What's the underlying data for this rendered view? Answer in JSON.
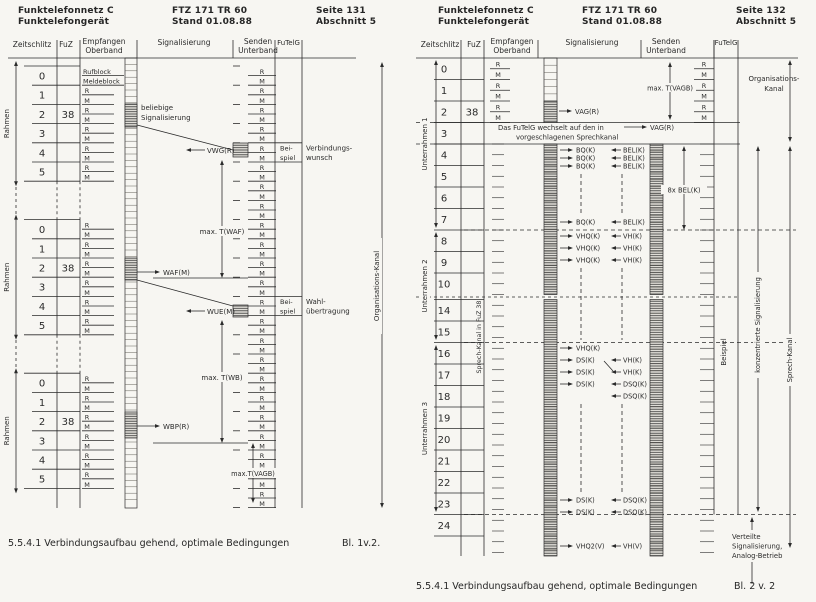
{
  "ink": "#2b2b2b",
  "paper": "#f7f6f2",
  "pages": [
    {
      "name": "seite-131",
      "header_left": [
        "Funktelefonnetz C",
        "Funktelefongerät"
      ],
      "header_center": [
        "FTZ 171 TR 60",
        "Stand 01.08.88"
      ],
      "header_right": [
        "Seite 131",
        "Abschnitt 5"
      ],
      "columns": {
        "zeitschlitz": "Zeitschlitz",
        "fuz": "FuZ",
        "empfangen": [
          "Empfangen",
          "Oberband"
        ],
        "signalisierung": "Signalisierung",
        "senden": [
          "Senden",
          "Unterband"
        ],
        "futelg": "FuTelG"
      },
      "rm": [
        "R",
        "M"
      ],
      "slot0_rx": [
        "Rufblock",
        "Meldeblock"
      ],
      "frame_label": "Rahmen",
      "fuz_value": "38",
      "slots": [
        "0",
        "1",
        "2",
        "3",
        "4",
        "5"
      ],
      "signals": {
        "beliebige": [
          "beliebige",
          "Signalisierung"
        ],
        "vwg": "VWG(R)",
        "max_waf": "max. T(WAF)",
        "waf": "WAF(M)",
        "wue": "WUE(M)",
        "max_wb": "max. T(WB)",
        "wbp": "WBP(R)",
        "max_vagb": "max.T(VAGB)"
      },
      "beispiel": [
        "Bei-",
        "spiel"
      ],
      "notes": {
        "verbindungswunsch": [
          "Verbindungs-",
          "wunsch"
        ],
        "wahluebertragung": [
          "Wahl-",
          "übertragung"
        ]
      },
      "channel_label": "Organisations-Kanal",
      "caption": "5.5.4.1 Verbindungsaufbau gehend, optimale Bedingungen",
      "sheet": "Bl. 1v.2."
    },
    {
      "name": "seite-132",
      "header_left": [
        "Funktelefonnetz C",
        "Funktelefongerät"
      ],
      "header_center": [
        "FTZ 171 TR 60",
        "Stand 01.08.88"
      ],
      "header_right": [
        "Seite 132",
        "Abschnitt 5"
      ],
      "columns": {
        "zeitschlitz": "Zeitschlitz",
        "fuz": "FuZ",
        "empfangen": [
          "Empfangen",
          "Oberband"
        ],
        "signalisierung": "Signalisierung",
        "senden": [
          "Senden",
          "Unterband"
        ],
        "futelg": "FuTelG"
      },
      "rm": [
        "R",
        "M"
      ],
      "fuz_value": "38",
      "rows": [
        "0",
        "1",
        "2",
        "3",
        "4",
        "5",
        "6",
        "7",
        "8",
        "9",
        "10",
        "14",
        "15",
        "16",
        "17",
        "18",
        "19",
        "20",
        "21",
        "22",
        "23",
        "24"
      ],
      "subframes": [
        "Unterrahmen 1",
        "Unterrahmen 2",
        "Unterrahmen 3"
      ],
      "sprech_fuz_label": "Sprech-Kanal in FuZ 38",
      "row3_text": [
        "Das FuTelG wechselt auf den in",
        "vorgeschlagenen Sprechkanal"
      ],
      "vag": "VAG(R)",
      "max_vagb": "max. T(VAGB)",
      "org_label": [
        "Organisations-",
        "Kanal"
      ],
      "events": [
        {
          "y": 150,
          "right": "BQ(K)",
          "left": "BEL(K)"
        },
        {
          "y": 158,
          "right": "BQ(K)",
          "left": "BEL(K)"
        },
        {
          "y": 166,
          "right": "BQ(K)",
          "left": "BEL(K)"
        },
        {
          "dash": [
            174,
            216
          ]
        },
        {
          "y": 222,
          "right": "BQ(K)",
          "left": "BEL(K)"
        },
        {
          "y": 236,
          "right": "VHQ(K)",
          "left": "VH(K)"
        },
        {
          "y": 248,
          "right": "VHQ(K)",
          "left": "VH(K)"
        },
        {
          "y": 260,
          "right": "VHQ(K)",
          "left": "VH(K)"
        },
        {
          "dash": [
            268,
            340
          ]
        },
        {
          "y": 348,
          "right": "VHQ(K)"
        },
        {
          "y": 360,
          "right": "DS(K)",
          "left": "VH(K)"
        },
        {
          "y": 372,
          "right": "DS(K)",
          "left": "VH(K)",
          "cross": true
        },
        {
          "y": 384,
          "right": "DS(K)",
          "left": "DSQ(K)"
        },
        {
          "y": 396,
          "left": "DSQ(K)"
        },
        {
          "dash": [
            404,
            494
          ]
        },
        {
          "y": 500,
          "right": "DS(K)",
          "left": "DSQ(K)"
        },
        {
          "y": 512,
          "right": "DS(K)",
          "left": "DSQ(K)"
        },
        {
          "y": 546,
          "right": "VHQ2(V)",
          "left": "VH(V)"
        }
      ],
      "acht_bel": "8x BEL(K)",
      "beispiel_label": "Beispiel",
      "konz_label": "konzentrierte Signalisierung",
      "sprech_label": "Sprech-Kanal",
      "verteilte": [
        "Verteilte",
        "Signalisierung,",
        "Analog-Betrieb"
      ],
      "caption": "5.5.4.1 Verbindungsaufbau gehend, optimale Bedingungen",
      "sheet": "Bl. 2 v. 2"
    }
  ]
}
